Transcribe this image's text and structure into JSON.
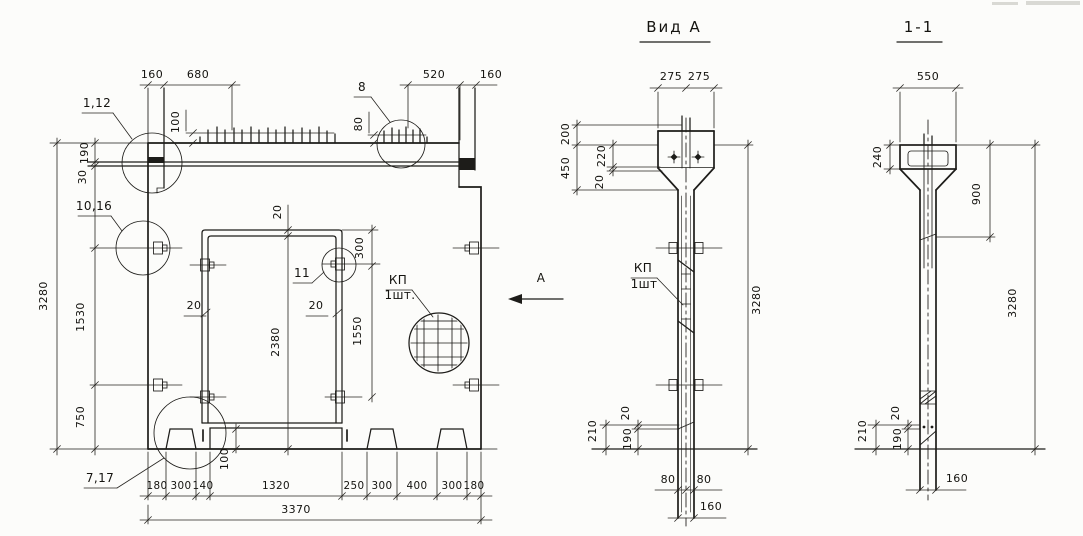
{
  "main_view": {
    "dims_top": [
      "160",
      "680",
      "520",
      "160"
    ],
    "dim_stud_left": "100",
    "dim_stud_right": "80",
    "dims_left": {
      "d190": "190",
      "d30": "30",
      "d3280": "3280",
      "d1530": "1530",
      "d750": "750"
    },
    "dims_opening": {
      "top_gap": "20",
      "d300": "300",
      "jamb_left": "20",
      "jamb_right": "20",
      "d2380": "2380",
      "d1550": "1550",
      "foot_step": "100"
    },
    "dims_bottom": [
      "180",
      "300",
      "140",
      "1320",
      "250",
      "300",
      "400",
      "300",
      "180"
    ],
    "dim_total_width": "3370",
    "callouts": {
      "top_left": "1,12",
      "mid_left": "10,16",
      "bottom_left": "7,17",
      "top_right": "8",
      "jamb": "11",
      "mesh_num": "КП",
      "mesh_qty": "1шт."
    }
  },
  "view_direction_label": "А",
  "view_a": {
    "title": "Вид А",
    "dims_top": [
      "275",
      "275"
    ],
    "dims_left": [
      "200",
      "450",
      "220",
      "20"
    ],
    "dim_height": "3280",
    "callout": {
      "mesh_num": "КП",
      "mesh_qty": "1шт"
    },
    "dims_bottom_left": [
      "210",
      "20",
      "190"
    ],
    "dims_bottom": [
      "80",
      "80",
      "160"
    ]
  },
  "section_1_1": {
    "title": "1-1",
    "dim_top": "550",
    "dim_left": "240",
    "dim_mid": "900",
    "dim_height": "3280",
    "dims_bottom_left": [
      "210",
      "20",
      "190"
    ],
    "dim_bottom": "160"
  }
}
